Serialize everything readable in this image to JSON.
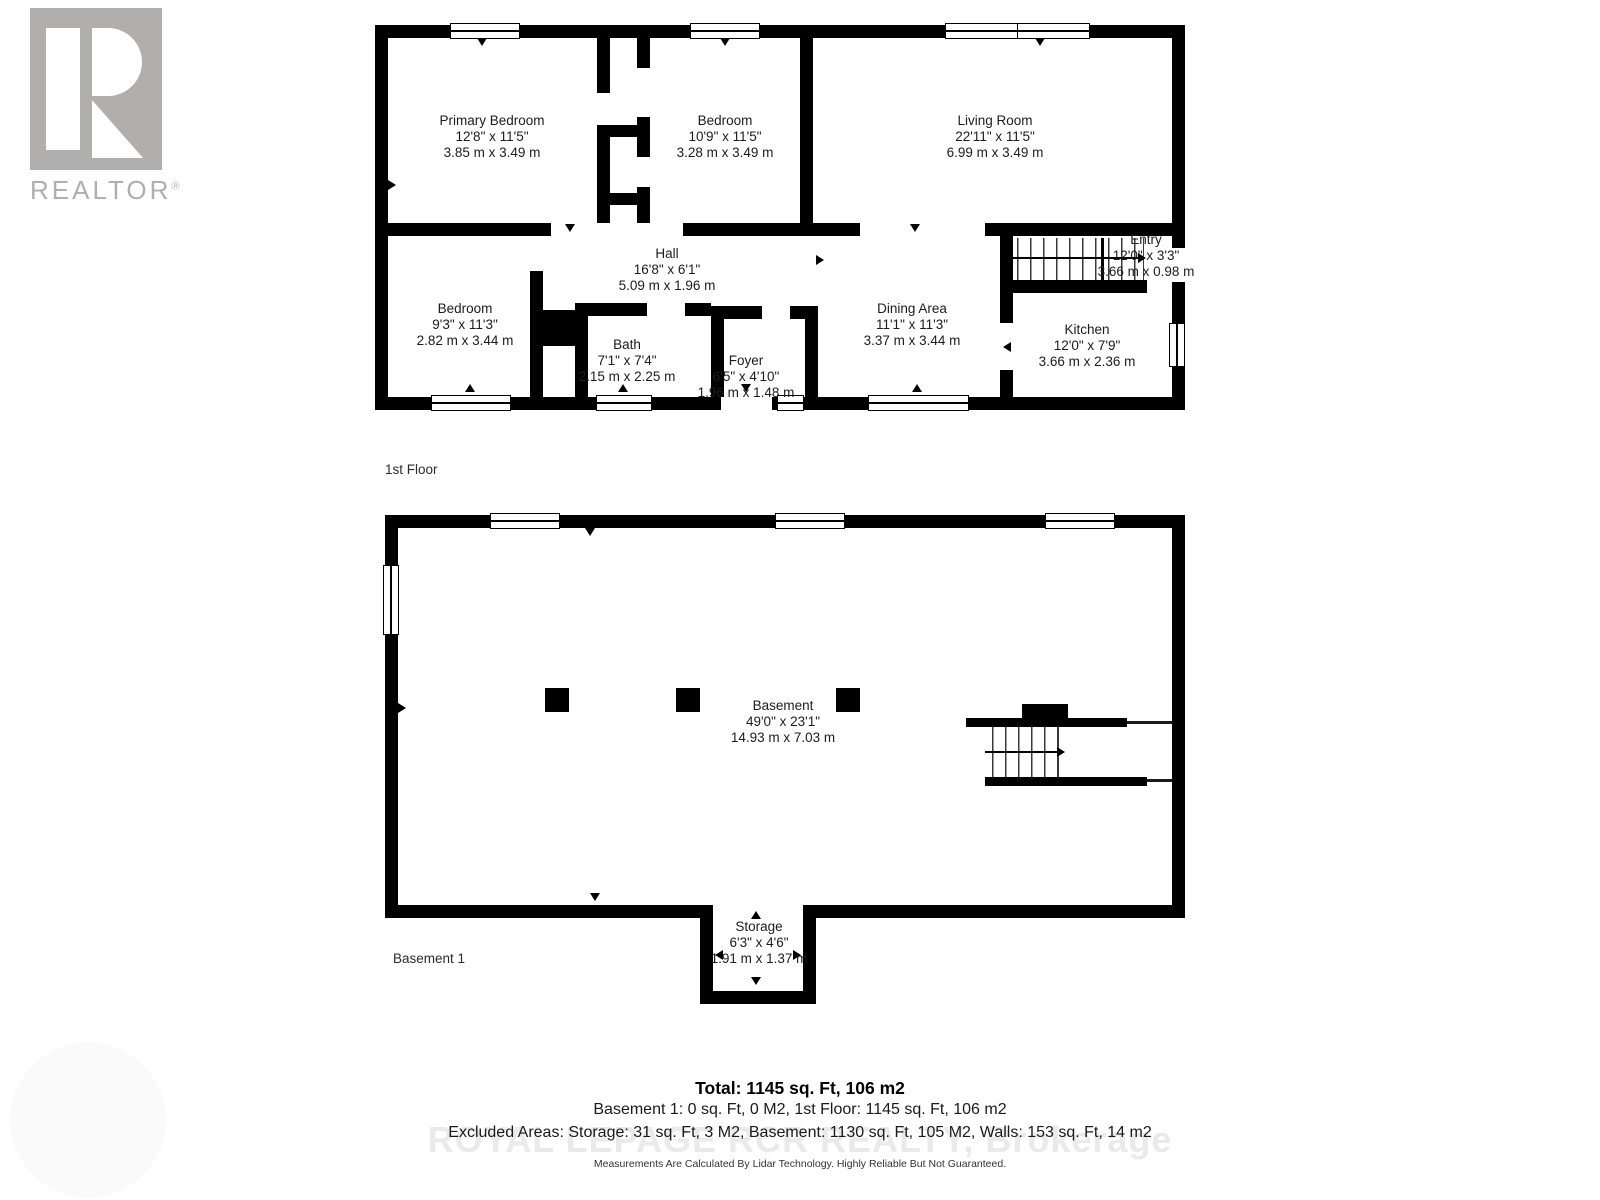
{
  "branding": {
    "realtor_logo_text": "REALTOR",
    "registered_mark": "®",
    "watermark": "ROYAL LEPAGE RCR REALTY, Brokerage"
  },
  "floors": [
    {
      "label": "1st Floor",
      "rooms": [
        {
          "name": "Primary Bedroom",
          "imperial": "12'8\" x 11'5\"",
          "metric": "3.85 m x 3.49 m"
        },
        {
          "name": "Bedroom",
          "imperial": "10'9\" x 11'5\"",
          "metric": "3.28 m x 3.49 m"
        },
        {
          "name": "Living Room",
          "imperial": "22'11\" x 11'5\"",
          "metric": "6.99 m x 3.49 m"
        },
        {
          "name": "Hall",
          "imperial": "16'8\" x 6'1\"",
          "metric": "5.09 m x 1.96 m"
        },
        {
          "name": "Entry",
          "imperial": "12'0\" x 3'3\"",
          "metric": "3.66 m x 0.98 m"
        },
        {
          "name": "Bedroom",
          "imperial": "9'3\" x 11'3\"",
          "metric": "2.82 m x 3.44 m"
        },
        {
          "name": "Bath",
          "imperial": "7'1\" x 7'4\"",
          "metric": "2.15 m x 2.25 m"
        },
        {
          "name": "Foyer",
          "imperial": "6'5\" x 4'10\"",
          "metric": "1.96 m x 1.48 m"
        },
        {
          "name": "Dining Area",
          "imperial": "11'1\" x 11'3\"",
          "metric": "3.37 m x 3.44 m"
        },
        {
          "name": "Kitchen",
          "imperial": "12'0\" x 7'9\"",
          "metric": "3.66 m x 2.36 m"
        }
      ]
    },
    {
      "label": "Basement 1",
      "rooms": [
        {
          "name": "Basement",
          "imperial": "49'0\" x 23'1\"",
          "metric": "14.93 m x 7.03 m"
        },
        {
          "name": "Storage",
          "imperial": "6'3\" x 4'6\"",
          "metric": "1.91 m x 1.37 m"
        }
      ]
    }
  ],
  "summary": {
    "total": "Total: 1145 sq. Ft, 106 m2",
    "floors_line": "Basement 1: 0 sq. Ft, 0 M2, 1st Floor: 1145 sq. Ft, 106 m2",
    "excluded_line": "Excluded Areas: Storage: 31 sq. Ft, 3 M2, Basement: 1130 sq. Ft, 105 M2, Walls: 153 sq. Ft, 14 m2",
    "disclaimer": "Measurements Are Calculated By Lidar Technology. Highly Reliable But Not Guaranteed."
  },
  "colors": {
    "wall": "#000000",
    "logo_gray": "#b1aeae",
    "watermark_gray": "#eaeaea"
  }
}
